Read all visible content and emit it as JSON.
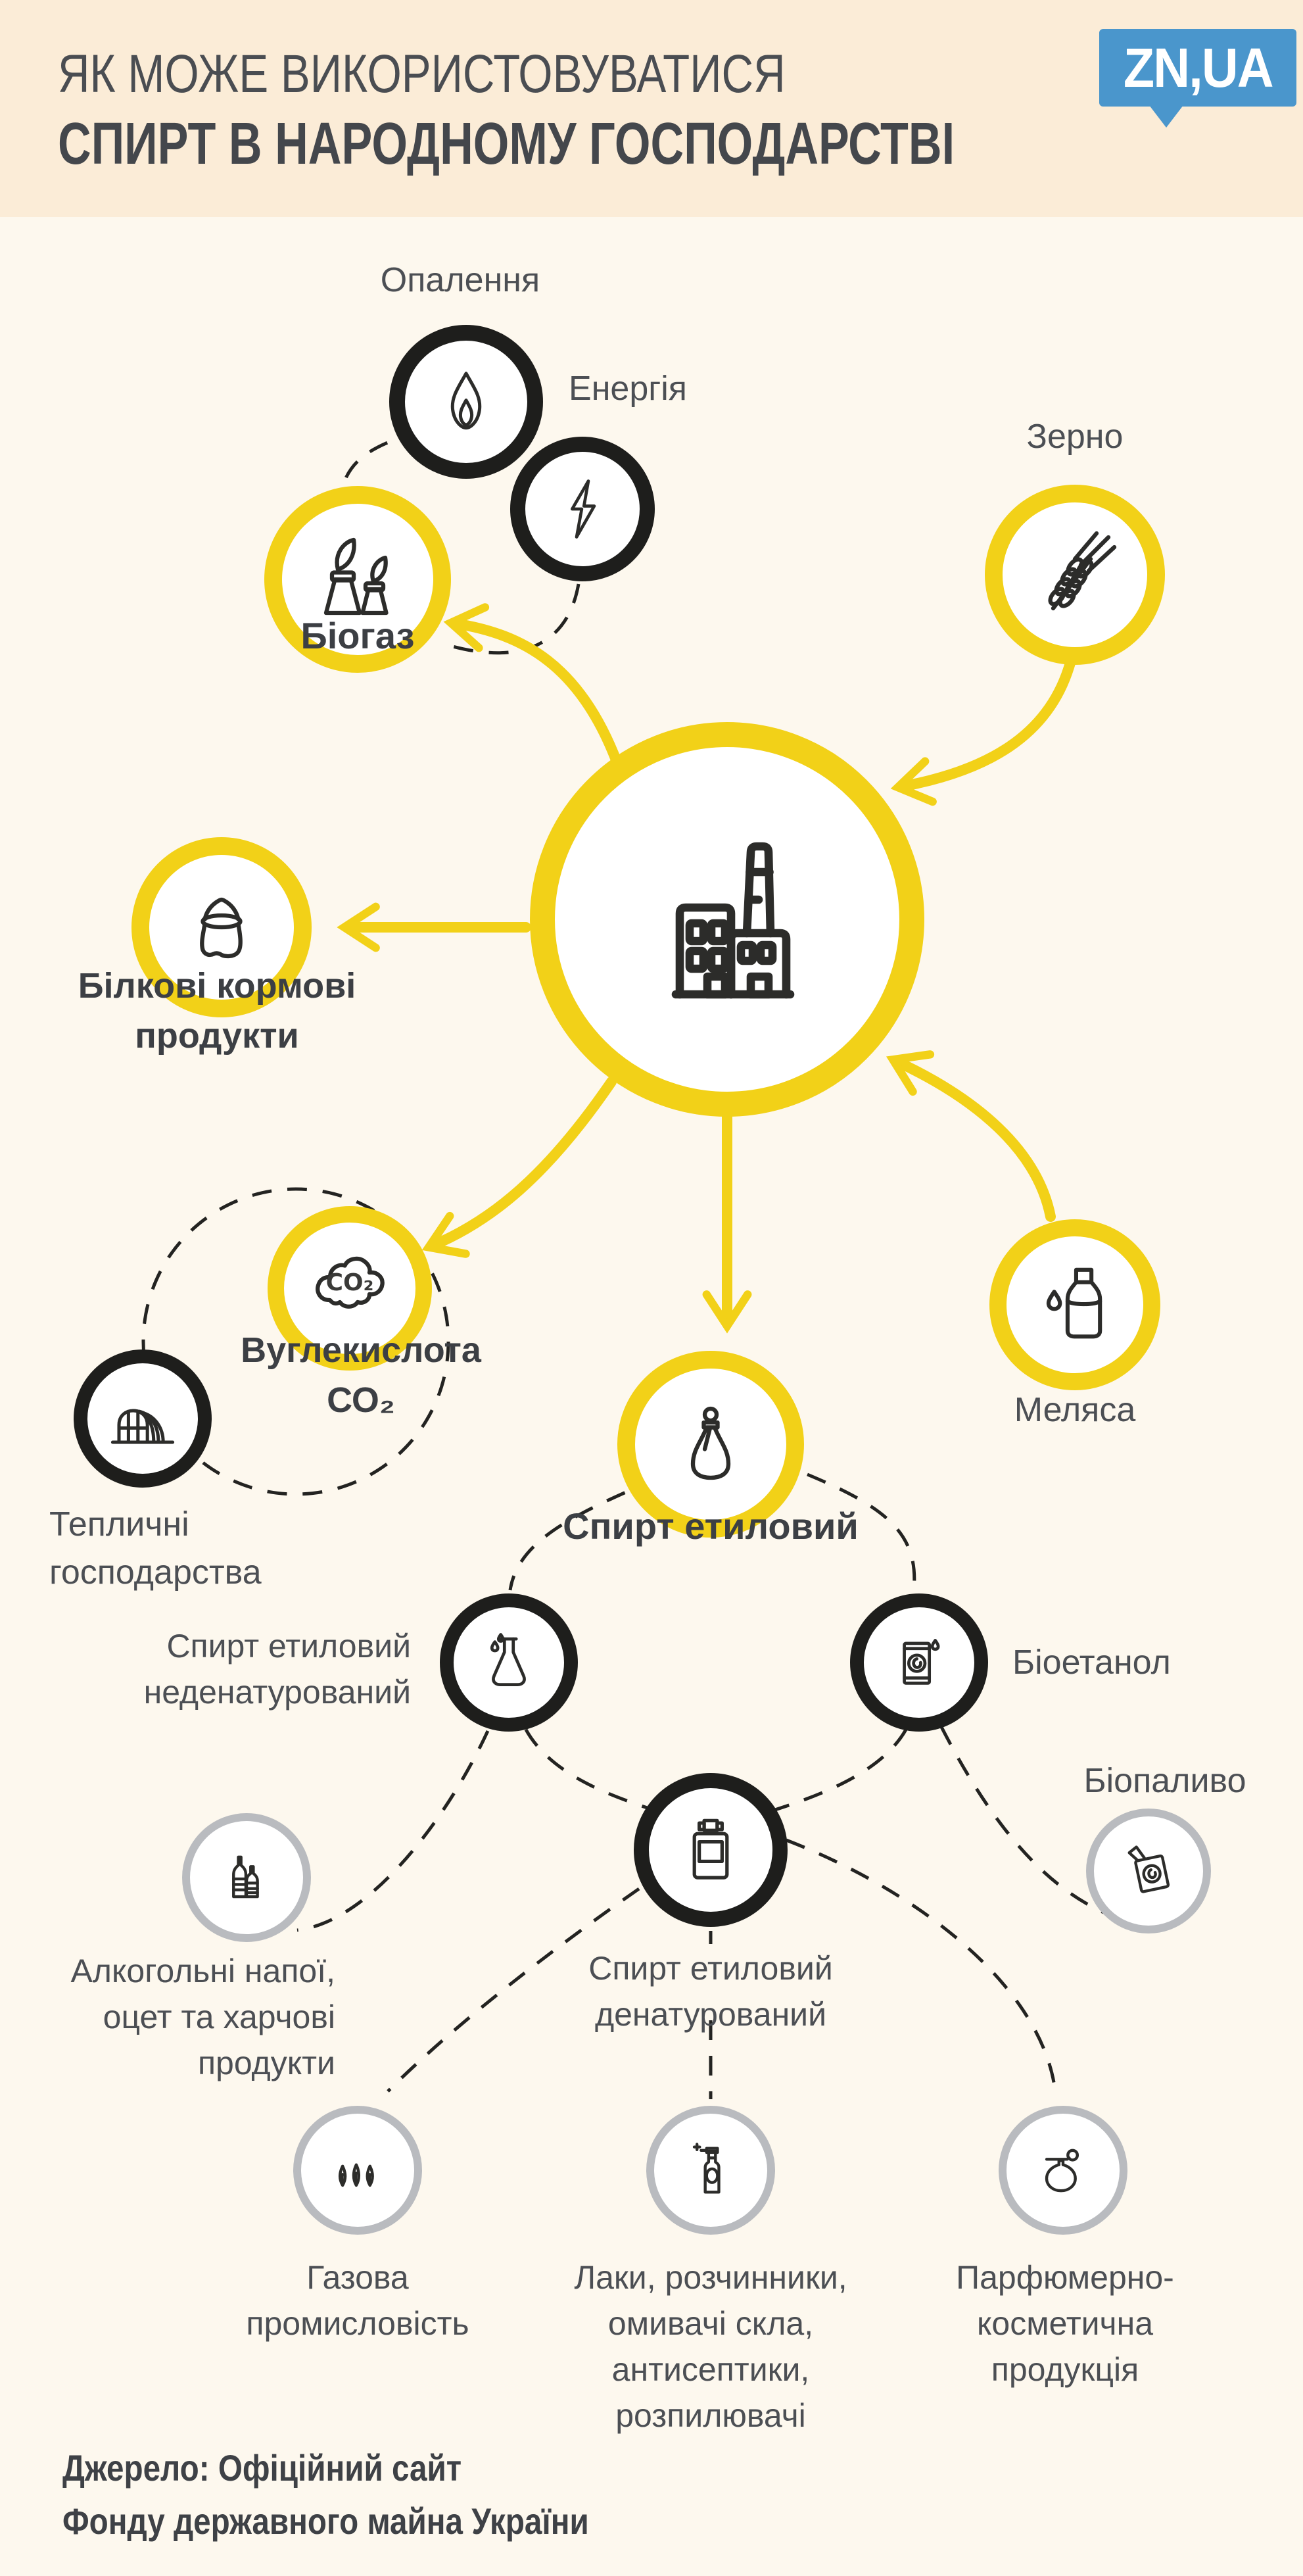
{
  "colors": {
    "background": "#fdf8ee",
    "header_background": "#fbecd7",
    "accent_yellow": "#f2d118",
    "ring_black": "#1e1e1c",
    "ring_gray": "#b9bbbf",
    "text": "#4c4f54",
    "logo_blue": "#4a96cc"
  },
  "header": {
    "title_line1": "ЯК МОЖЕ ВИКОРИСТОВУВАТИСЯ",
    "title_line2": "СПИРТ В НАРОДНОМУ ГОСПОДАРСТВІ",
    "logo_text": "ZN,UA"
  },
  "nodes": {
    "heating": {
      "label": "Опалення"
    },
    "energy": {
      "label": "Енергія"
    },
    "biogas": {
      "label": "Біогаз"
    },
    "grain": {
      "label": "Зерно"
    },
    "protein_feed": {
      "label": "Білкові кормові\nпродукти"
    },
    "co2": {
      "label": "Вуглекислота\nСО₂",
      "icon_text": "CO₂"
    },
    "greenhouse": {
      "label": "Тепличні\nгосподарства"
    },
    "molasses": {
      "label": "Меляса"
    },
    "ethanol": {
      "label": "Спирт етиловий"
    },
    "undenatured": {
      "label": "Спирт етиловий\nнеденатурований"
    },
    "bioethanol": {
      "label": "Біоетанол"
    },
    "biofuel": {
      "label": "Біопаливо"
    },
    "alcoholic": {
      "label": "Алкогольні напої,\nоцет та харчові\nпродукти"
    },
    "denatured": {
      "label": "Спирт етиловий\nденатурований"
    },
    "gas_industry": {
      "label": "Газова\nпромисловість"
    },
    "lacquers": {
      "label": "Лаки, розчинники,\nомивачі скла,\nантисептики,\nрозпилювачі"
    },
    "perfume": {
      "label": "Парфюмерно-\nкосметична\nпродукція"
    }
  },
  "footer": {
    "source": "Джерело: Офіційний сайт\nФонду державного майна України"
  }
}
